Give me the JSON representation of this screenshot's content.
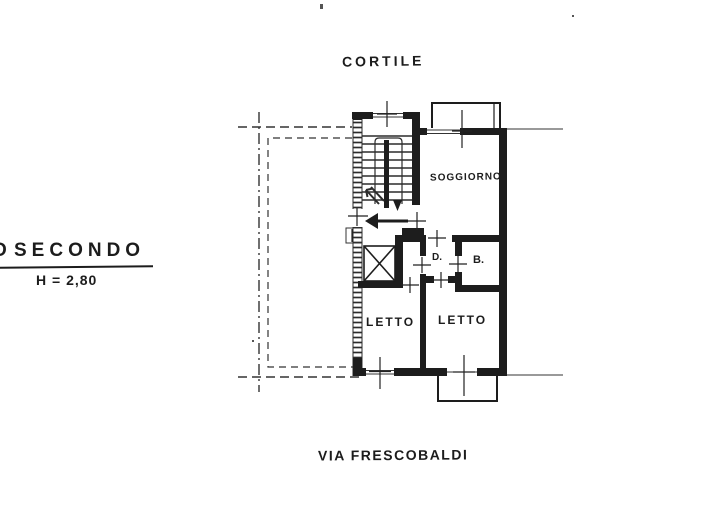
{
  "page": {
    "background_color": "#ffffff",
    "ink_color": "#1d1d1d"
  },
  "plan": {
    "courtyard_label": "CORTILE",
    "street_label": "VIA FRESCOBALDI",
    "floor_label": "SECONDO",
    "floor_label_fragment": "O",
    "height_label": "H = 2,80",
    "rooms": {
      "living": "SOGGIORNO",
      "hallway": "D.",
      "bathroom": "B.",
      "bedroom_left": "LETTO",
      "bedroom_right": "LETTO"
    }
  }
}
